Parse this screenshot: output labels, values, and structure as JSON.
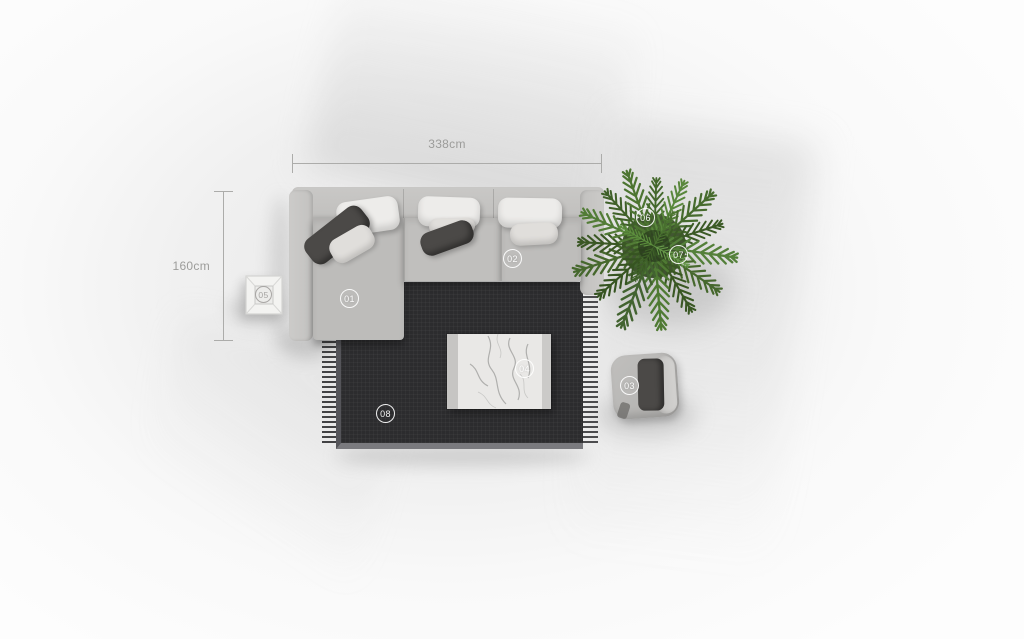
{
  "annotations": {
    "width_dimension": "338cm",
    "depth_dimension": "160cm"
  },
  "markers": [
    {
      "id": "01",
      "target": "sofa-chaise-section"
    },
    {
      "id": "02",
      "target": "sofa-seat-section"
    },
    {
      "id": "03",
      "target": "pouf"
    },
    {
      "id": "04",
      "target": "coffee-table"
    },
    {
      "id": "05",
      "target": "side-table"
    },
    {
      "id": "06",
      "target": "plant"
    },
    {
      "id": "07",
      "target": "plant"
    },
    {
      "id": "08",
      "target": "rug"
    }
  ],
  "palette": {
    "background": "#f3f3f3",
    "sofa_fabric": "#c0bfbd",
    "dark_pillow": "#4b4947",
    "white_pillow": "#edecea",
    "rug": "#2c2c2e",
    "marble": "#e9e8e6",
    "plant_green": "#4a6c2f",
    "dimension_gray": "#9c9c9a",
    "marker_white": "#ffffff"
  }
}
